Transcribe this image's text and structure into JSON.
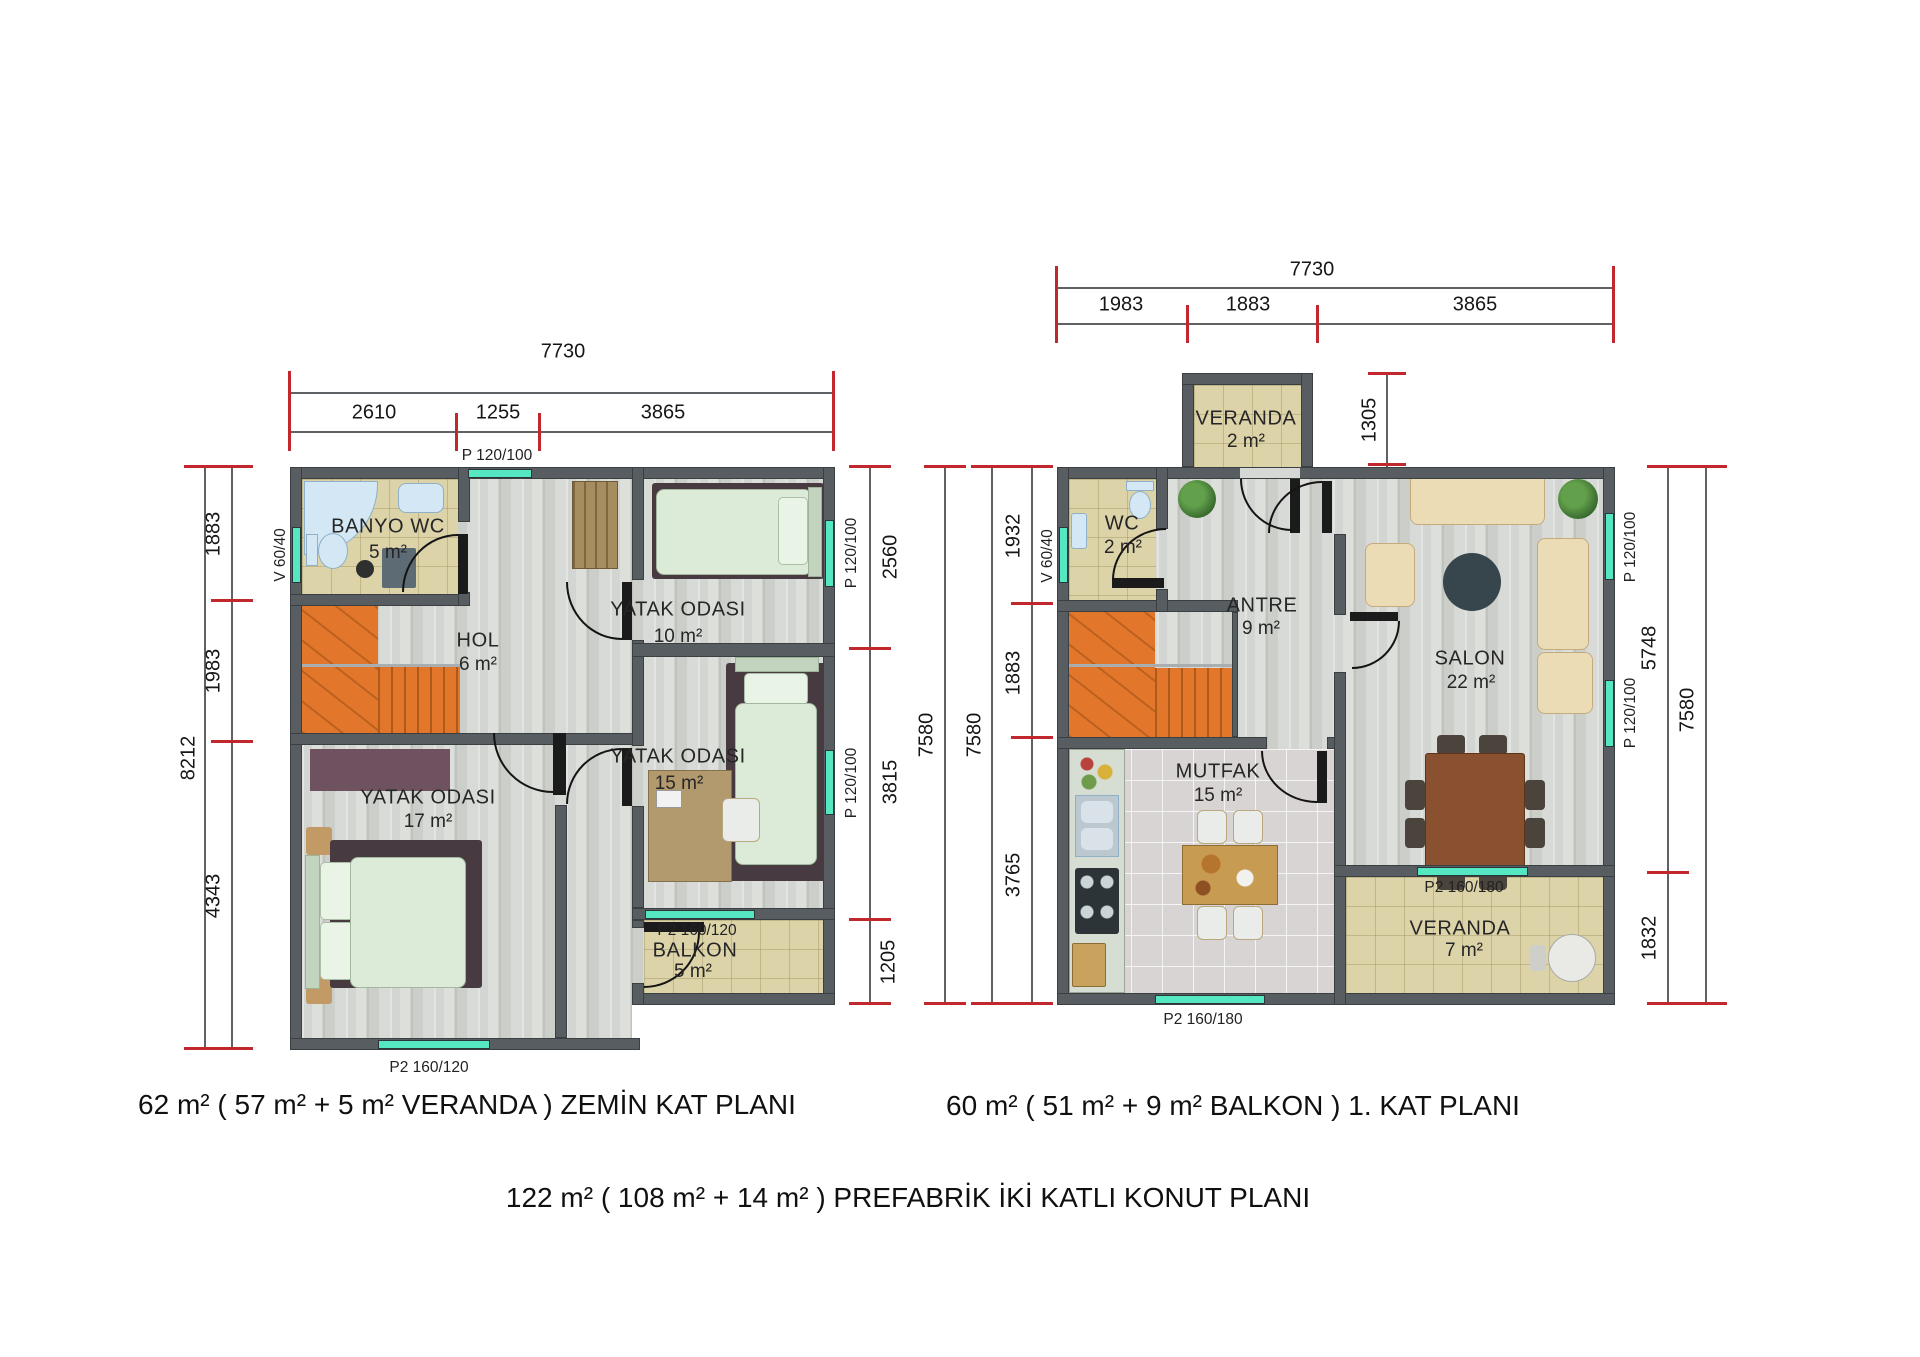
{
  "captions": {
    "ground": "62 m²  ( 57 m² + 5 m²  VERANDA ) ZEMİN KAT  PLANI",
    "first": "60 m² ( 51 m² + 9 m² BALKON ) 1. KAT  PLANI",
    "total": "122  m²  ( 108 m² + 14 m² )  PREFABRİK İKİ KATLI KONUT PLANI"
  },
  "ground": {
    "dims": {
      "top_total": "7730",
      "top_segs": [
        "2610",
        "1255",
        "3865"
      ],
      "left_total": "8212",
      "left_segs": [
        "1883",
        "1983",
        "4343"
      ],
      "right_total": "7580",
      "right_segs": [
        "2560",
        "3815",
        "1205"
      ]
    },
    "windows": {
      "top": "P 120/100",
      "left": "V 60/40",
      "right_upper": "P 120/100",
      "right_lower": "P 120/100",
      "balkon": "P2 160/120",
      "bottom": "P2 160/120"
    },
    "rooms": {
      "banyo": {
        "name": "BANYO WC",
        "area": "5 m²"
      },
      "hol": {
        "name": "HOL",
        "area": "6 m²"
      },
      "yatak10": {
        "name": "YATAK  ODASI",
        "area": "10 m²"
      },
      "yatak15": {
        "name": "YATAK  ODASI",
        "area": "15 m²"
      },
      "yatak17": {
        "name": "YATAK  ODASI",
        "area": "17 m²"
      },
      "balkon": {
        "name": "BALKON",
        "area": "5 m²"
      }
    }
  },
  "first": {
    "dims": {
      "top_total": "7730",
      "top_segs": [
        "1983",
        "1883",
        "3865"
      ],
      "veranda_depth": "1305",
      "left_total": "7580",
      "left_segs": [
        "1932",
        "1883",
        "3765"
      ],
      "right_total": "7580",
      "right_segs": [
        "5748",
        "1832"
      ]
    },
    "windows": {
      "wc": "V 60/40",
      "salon_upper": "P 120/100",
      "salon_lower": "P 120/100",
      "veranda": "P2 160/180",
      "mutfak": "P2 160/180"
    },
    "rooms": {
      "veranda2": {
        "name": "VERANDA",
        "area": "2 m²"
      },
      "wc": {
        "name": "WC",
        "area": "2 m²"
      },
      "antre": {
        "name": "ANTRE",
        "area": "9 m²"
      },
      "salon": {
        "name": "SALON",
        "area": "22 m²"
      },
      "mutfak": {
        "name": "MUTFAK",
        "area": "15 m²"
      },
      "veranda7": {
        "name": "VERANDA",
        "area": "7 m²"
      }
    }
  }
}
